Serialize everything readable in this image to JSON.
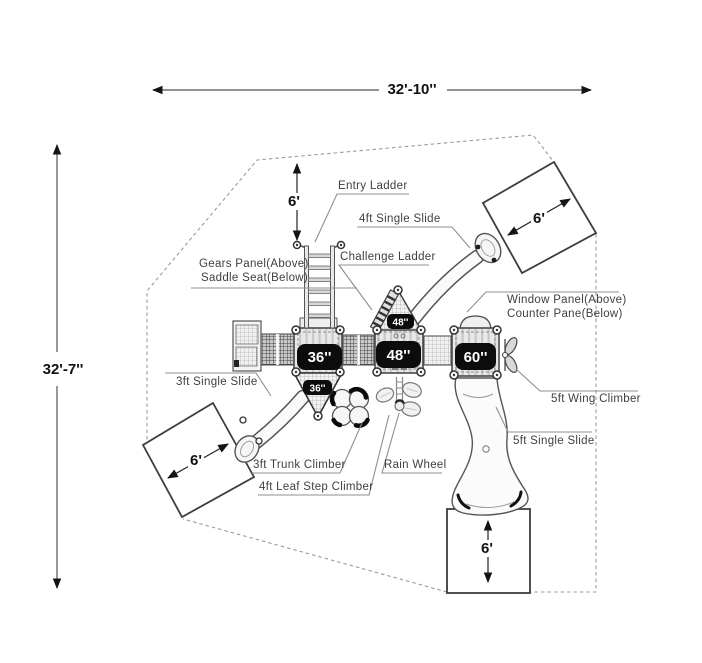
{
  "title": "playground-structure-plan",
  "dimensions": {
    "width_label": "32'-10''",
    "height_label": "32'-7''"
  },
  "zones": {
    "top": "6'",
    "top_right": "6'",
    "bottom_left": "6'",
    "bottom": "6'"
  },
  "platforms": {
    "p36": "36''",
    "p36_small": "36''",
    "p48": "48''",
    "p48_small": "48''",
    "p60": "60''"
  },
  "labels": {
    "entry_ladder": "Entry Ladder",
    "four_ft_single_slide": "4ft Single Slide",
    "challenge_ladder": "Challenge Ladder",
    "gears_panel": "Gears Panel(Above)",
    "saddle_seat": "Saddle Seat(Below)",
    "window_panel": "Window Panel(Above)",
    "counter_pane": "Counter Pane(Below)",
    "three_ft_single_slide": "3ft Single Slide",
    "five_ft_wing_climber": "5ft Wing Climber",
    "five_ft_single_slide": "5ft Single Slide",
    "three_ft_trunk_climber": "3ft Trunk Climber",
    "rain_wheel": "Rain Wheel",
    "four_ft_leaf_step_climber": "4ft Leaf Step Climber"
  },
  "colors": {
    "line": "#4a4a4a",
    "leader": "#8f8f8f",
    "boundary_dash": "#9a9a9a",
    "badge_bg": "#0c0c0c",
    "badge_text": "#ffffff",
    "platform_fill": "#e8e8e8"
  }
}
